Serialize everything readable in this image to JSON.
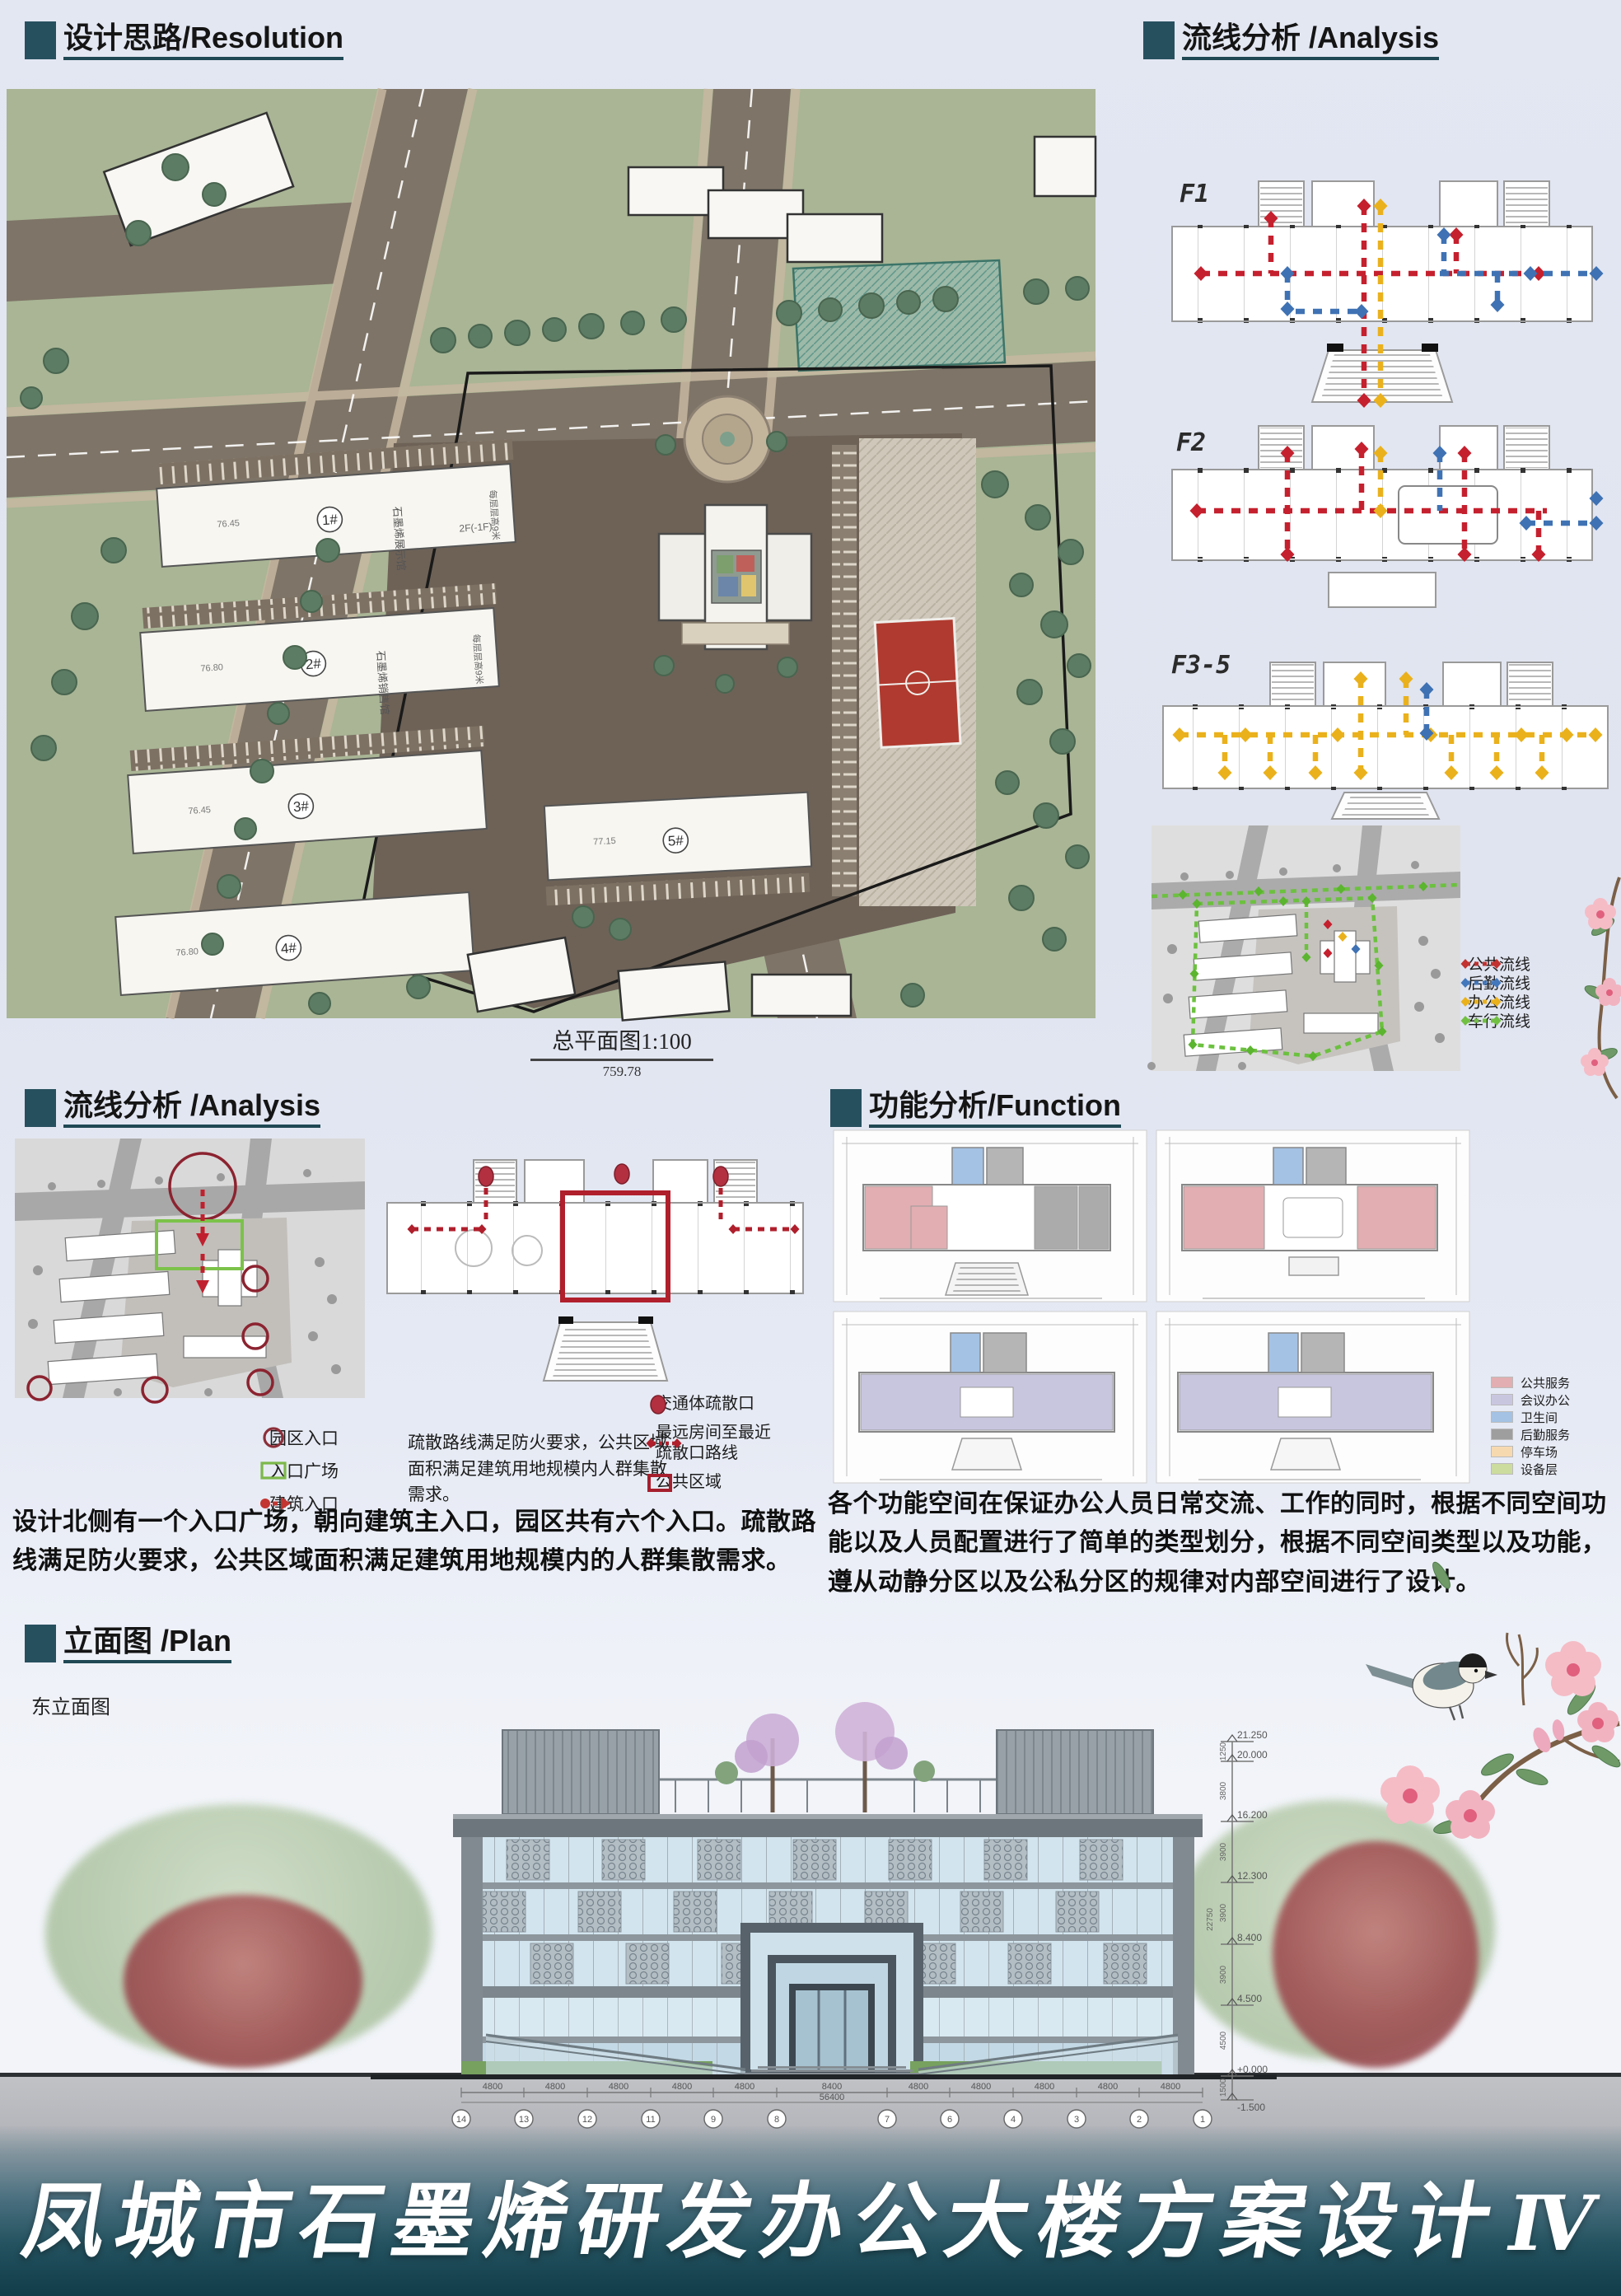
{
  "board": {
    "title": "凤城市石墨烯研发办公大楼方案设计",
    "title_numeral": "Ⅳ"
  },
  "resolution": {
    "header": "设计思路/Resolution",
    "caption": "总平面图1:100",
    "caption_value": "759.78",
    "floor_note": "每层层高9米",
    "storey_note": "2F(-1F)",
    "buildings": [
      {
        "no": "1#",
        "name": "石墨烯展示馆"
      },
      {
        "no": "2#",
        "name": "石墨烯销售馆"
      },
      {
        "no": "3#",
        "name": ""
      },
      {
        "no": "4#",
        "name": ""
      },
      {
        "no": "5#",
        "name": ""
      }
    ]
  },
  "flow_right": {
    "header": "流线分析 /Analysis",
    "floors": [
      "F1",
      "F2",
      "F3-5"
    ],
    "legend": [
      {
        "label": "公共流线",
        "color": "#c23230"
      },
      {
        "label": "后勤流线",
        "color": "#4478bc"
      },
      {
        "label": "办公流线",
        "color": "#eab11c"
      },
      {
        "label": "车行流线",
        "color": "#72c043"
      }
    ]
  },
  "flow_left": {
    "header": "流线分析 /Analysis",
    "entrance_legend": [
      {
        "label": "园区入口"
      },
      {
        "label": "入口广场"
      },
      {
        "label": "建筑入口"
      }
    ],
    "note": "疏散路线满足防火要求，公共区域面积满足建筑用地规模内人群集散需求。",
    "escape_legend": [
      {
        "label": "交通体疏散口"
      },
      {
        "label": "最远房间至最近\n疏散口路线"
      },
      {
        "label": "公共区域"
      }
    ],
    "body": "设计北侧有一个入口广场，朝向建筑主入口，园区共有六个入口。疏散路线满足防火要求，公共区域面积满足建筑用地规模内的人群集散需求。"
  },
  "function": {
    "header": "功能分析/Function",
    "legend": [
      {
        "label": "公共服务",
        "color": "#e2aeb1"
      },
      {
        "label": "会议办公",
        "color": "#c8c6df"
      },
      {
        "label": "卫生间",
        "color": "#a4c2e4"
      },
      {
        "label": "后勤服务",
        "color": "#9e9e9e"
      },
      {
        "label": "停车场",
        "color": "#f7d9b0"
      },
      {
        "label": "设备层",
        "color": "#ccdc9e"
      }
    ],
    "body": "各个功能空间在保证办公人员日常交流、工作的同时，根据不同空间功能以及人员配置进行了简单的类型划分，根据不同空间类型以及功能，遵从动静分区以及公私分区的规律对内部空间进行了设计。"
  },
  "elevation": {
    "header": "立面图 /Plan",
    "sublabel": "东立面图",
    "levels": [
      "21.250",
      "20.000",
      "16.200",
      "12.300",
      "8.400",
      "4.500",
      "+0.000",
      "-1.500"
    ],
    "side_dims": [
      "1250",
      "3800",
      "3900",
      "3900",
      "3900",
      "4500",
      "1500"
    ],
    "side_total": "22750",
    "grid_bubbles": [
      "14",
      "13",
      "12",
      "11",
      "9",
      "8",
      "7",
      "6",
      "4",
      "3",
      "2",
      "1"
    ],
    "dim_segments": [
      "4800",
      "4800",
      "4800",
      "4800",
      "4800",
      "8400",
      "4800",
      "4800",
      "4800",
      "4800",
      "4800"
    ],
    "dim_total": "56400"
  }
}
